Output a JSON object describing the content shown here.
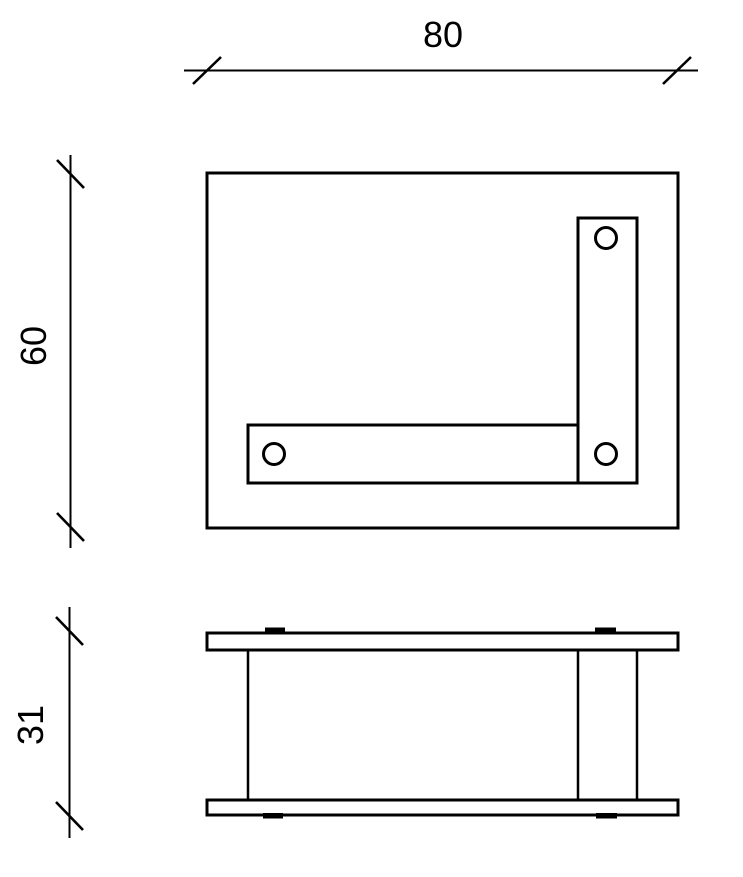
{
  "drawing": {
    "type": "technical-drawing",
    "views": 2,
    "dimensions": {
      "width": "80",
      "depth": "60",
      "height": "31"
    },
    "hole_count": 3,
    "colors": {
      "line": "#000000",
      "background": "#ffffff"
    }
  }
}
